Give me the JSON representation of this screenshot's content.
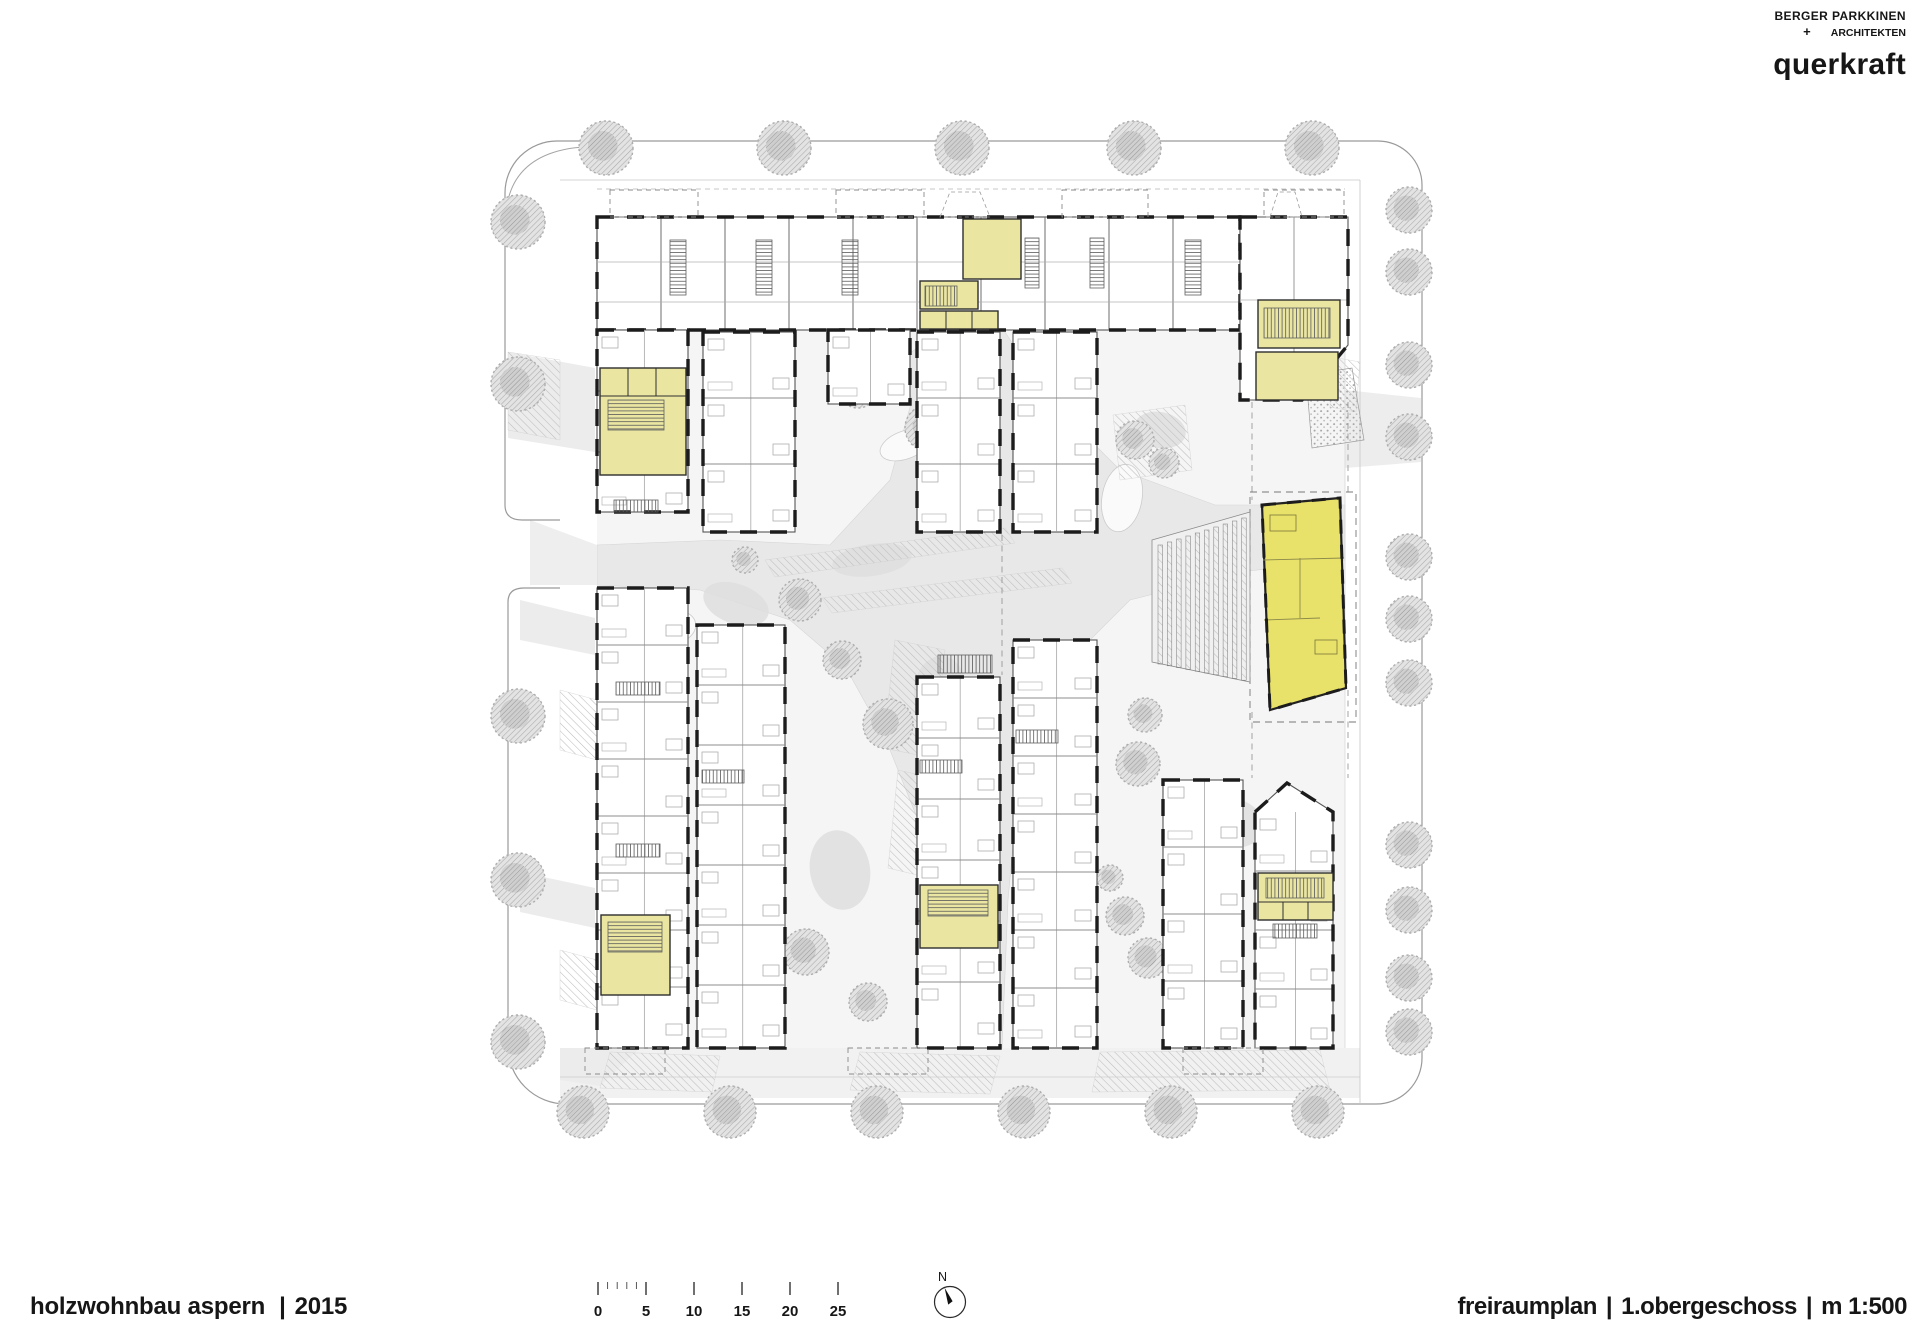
{
  "header": {
    "firm_primary_line1": "BERGER PARKKINEN",
    "firm_primary_plus": "+",
    "firm_primary_line2": "ARCHITEKTEN",
    "firm_secondary": "querkraft"
  },
  "footer_left": {
    "project": "holzwohnbau aspern",
    "divider": "|",
    "year": "2015"
  },
  "footer_right": {
    "items": [
      "freiraumplan",
      "1.obergeschoss",
      "m 1:500"
    ],
    "divider": "|"
  },
  "scalebar": {
    "labels": [
      "0",
      "5",
      "10",
      "15",
      "20",
      "25"
    ]
  },
  "north": {
    "label": "N"
  },
  "colors": {
    "stair_core_yellow": "#eae6a2",
    "highlight_unit_yellow": "#e9e26a",
    "wall_black": "#1c1c1c",
    "tree_gray": "#a9a9a9",
    "ground_gray": "#e8e8e8",
    "boundary_gray": "#9a9a9a",
    "hatch_gray": "#bdbdbd"
  }
}
